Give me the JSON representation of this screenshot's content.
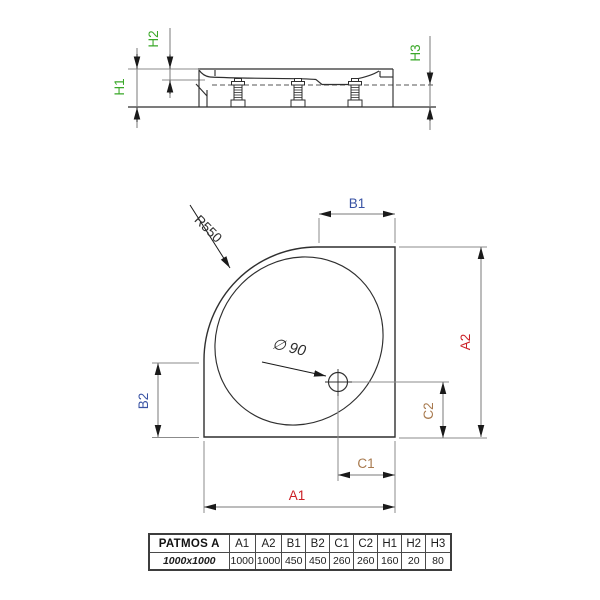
{
  "colors": {
    "red": "#cb2026",
    "blue": "#3953a4",
    "brown": "#a87a4f",
    "green": "#3aa828",
    "line": "#2f2f2f"
  },
  "side_view": {
    "h1": "H1",
    "h2": "H2",
    "h3": "H3"
  },
  "plan_view": {
    "radius_label": "R550",
    "drain_label": "∅ 90",
    "a1": "A1",
    "a2": "A2",
    "b1": "B1",
    "b2": "B2",
    "c1": "C1",
    "c2": "C2"
  },
  "table": {
    "model": "PATMOS A",
    "size": "1000x1000",
    "columns": [
      {
        "label": "A1",
        "value": "1000",
        "color": "red"
      },
      {
        "label": "A2",
        "value": "1000",
        "color": "red"
      },
      {
        "label": "B1",
        "value": "450",
        "color": "blue"
      },
      {
        "label": "B2",
        "value": "450",
        "color": "blue"
      },
      {
        "label": "C1",
        "value": "260",
        "color": "brown"
      },
      {
        "label": "C2",
        "value": "260",
        "color": "brown"
      },
      {
        "label": "H1",
        "value": "160",
        "color": "green"
      },
      {
        "label": "H2",
        "value": "20",
        "color": "green"
      },
      {
        "label": "H3",
        "value": "80",
        "color": "green"
      }
    ]
  }
}
